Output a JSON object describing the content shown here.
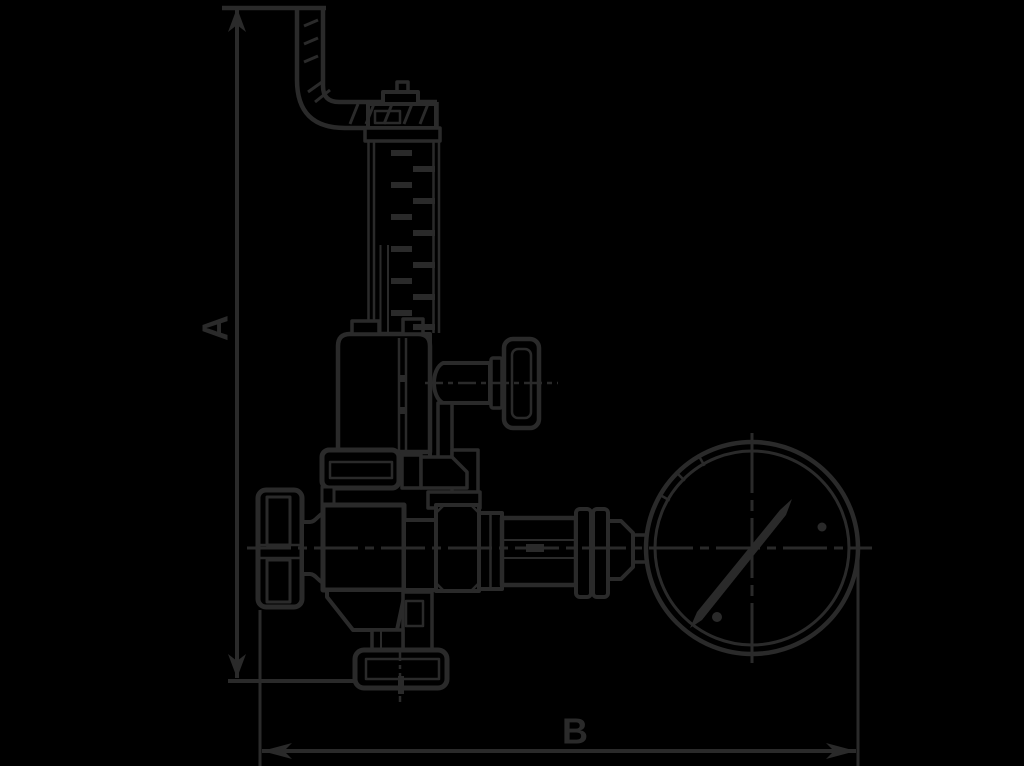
{
  "page": {
    "background_color": "#000000",
    "line_color": "#2a2a2a"
  },
  "drawing": {
    "dimensions": {
      "vertical": {
        "label": "A"
      },
      "horizontal": {
        "label": "B"
      }
    },
    "components": [
      "discharge-pipe-elbow",
      "spring-bonnet-tube",
      "spring-coils",
      "bonnet-housing",
      "side-port-knob",
      "union-nut",
      "valve-body",
      "hand-knob",
      "gauge-coupling-train",
      "pressure-gauge",
      "gauge-needle",
      "bottom-inlet-flange",
      "dimension-line-A",
      "dimension-line-B"
    ]
  }
}
